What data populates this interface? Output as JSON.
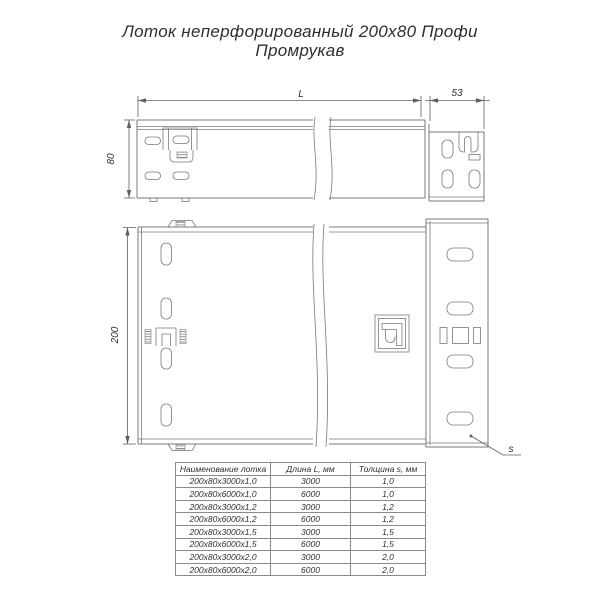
{
  "title": {
    "line1": "Лоток неперфорированный 200х80 Профи",
    "line2": "Промрукав"
  },
  "drawing": {
    "dim_length_label": "L",
    "dim_end_label": "53",
    "dim_height_label": "80",
    "dim_width_label": "200",
    "thickness_label": "s"
  },
  "table": {
    "headers": [
      "Наименование лотка",
      "Длина L, мм",
      "Толщина s, мм"
    ],
    "rows": [
      {
        "name": "200х80х3000х1,0",
        "length": "3000",
        "thickness": "1,0"
      },
      {
        "name": "200х80х6000х1,0",
        "length": "6000",
        "thickness": "1,0"
      },
      {
        "name": "200х80х3000х1,2",
        "length": "3000",
        "thickness": "1,2"
      },
      {
        "name": "200х80х6000х1,2",
        "length": "6000",
        "thickness": "1,2"
      },
      {
        "name": "200х80х3000х1,5",
        "length": "3000",
        "thickness": "1,5"
      },
      {
        "name": "200х80х6000х1,5",
        "length": "6000",
        "thickness": "1,5"
      },
      {
        "name": "200х80х3000х2,0",
        "length": "3000",
        "thickness": "2,0"
      },
      {
        "name": "200х80х6000х2,0",
        "length": "6000",
        "thickness": "2,0"
      }
    ]
  },
  "colors": {
    "line": "#7a7a7a",
    "dim": "#5f5f5f",
    "text": "#2f2f2f"
  }
}
